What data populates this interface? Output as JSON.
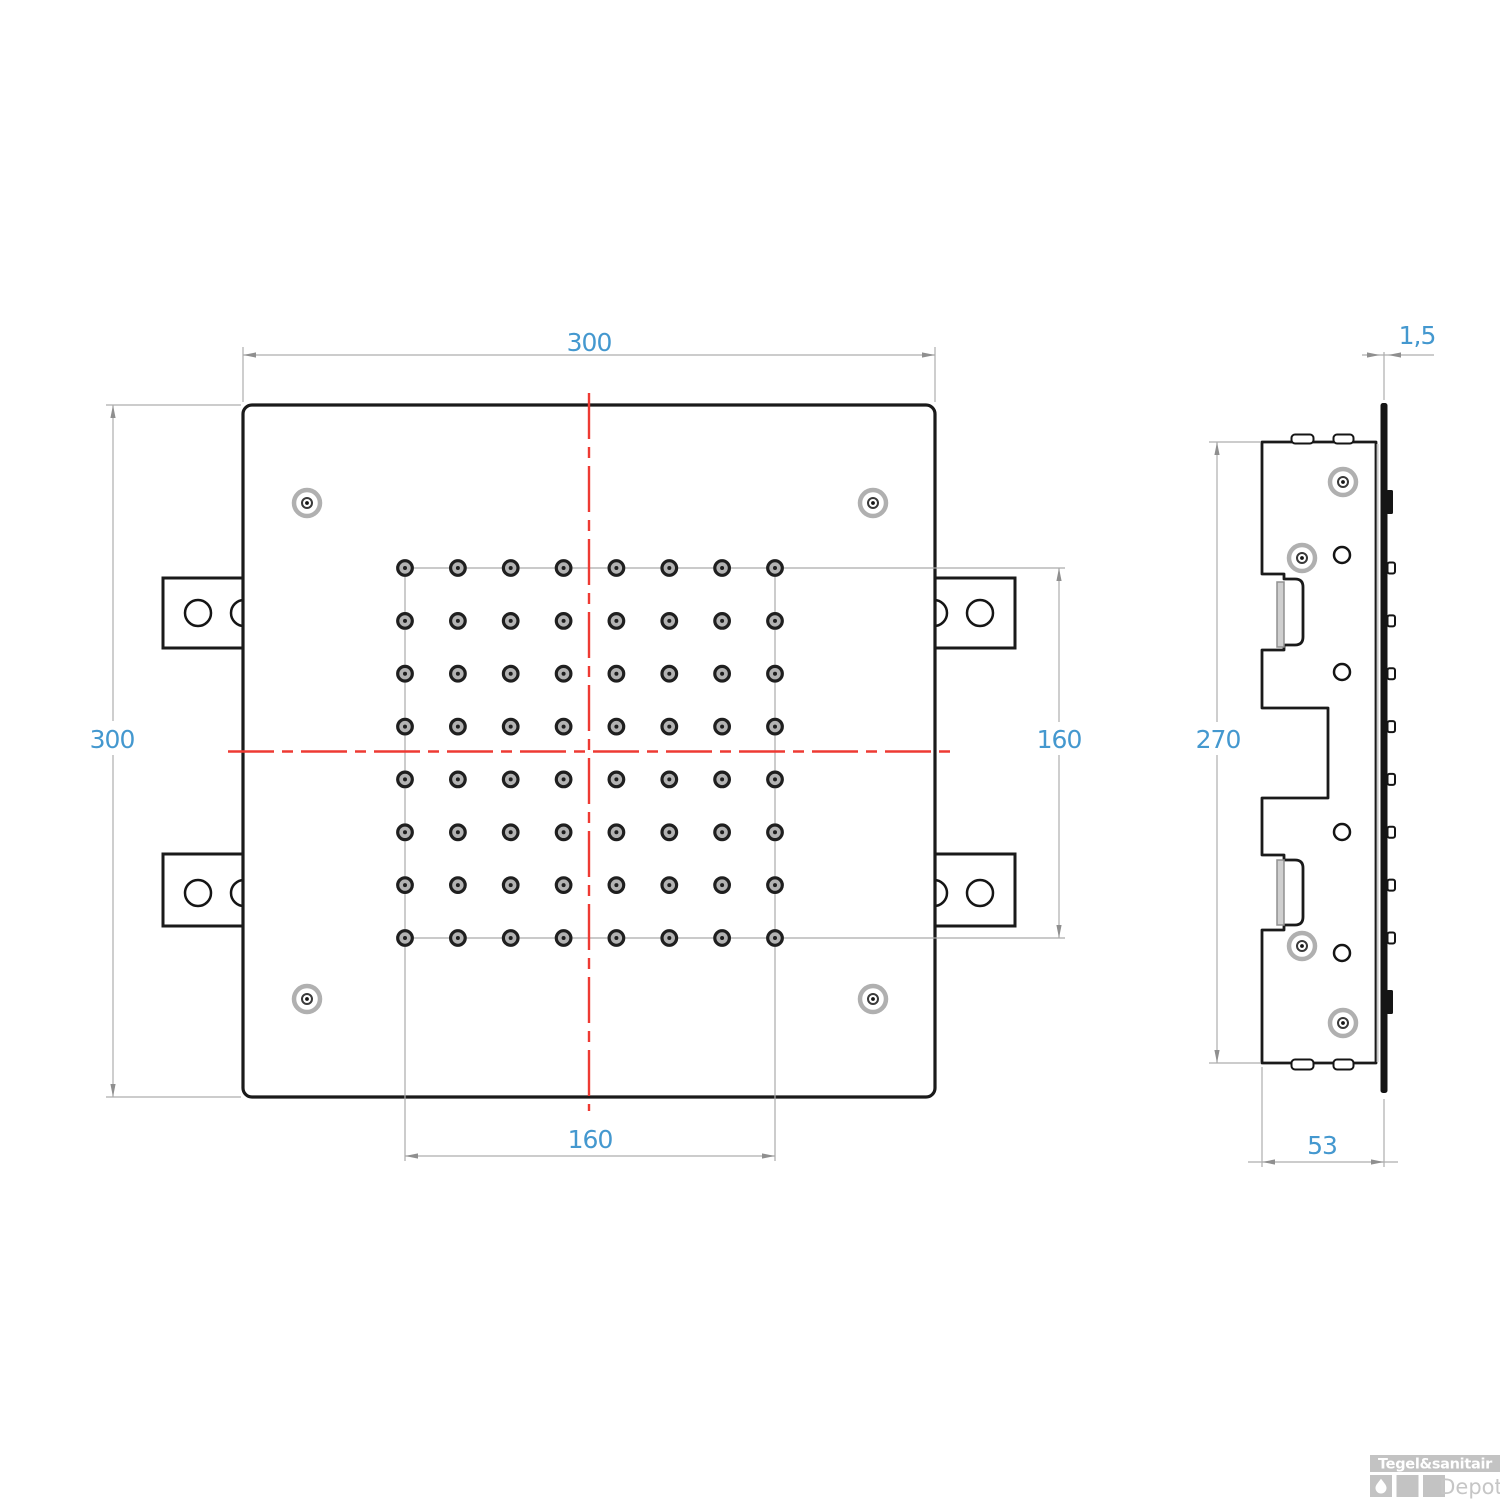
{
  "drawing": {
    "front_view": {
      "top_width_label": "300",
      "left_height_label": "300",
      "nozzle_field_height_label": "160",
      "nozzle_field_width_label": "160",
      "nozzle_grid": {
        "rows": 8,
        "cols": 8
      }
    },
    "side_view": {
      "height_label": "270",
      "depth_label": "53",
      "plate_thickness_label": "1,5"
    },
    "colors": {
      "outline": "#1a1a1a",
      "dimension_line": "#aeaeae",
      "dimension_text": "#4498cf",
      "centerline_red": "#ee3a33",
      "watermark_gray": "#c3c3c3"
    }
  },
  "watermark": {
    "brand": "Tegel&sanitair",
    "sub_brand": "Depot",
    "icon": "water-drop-icon"
  }
}
